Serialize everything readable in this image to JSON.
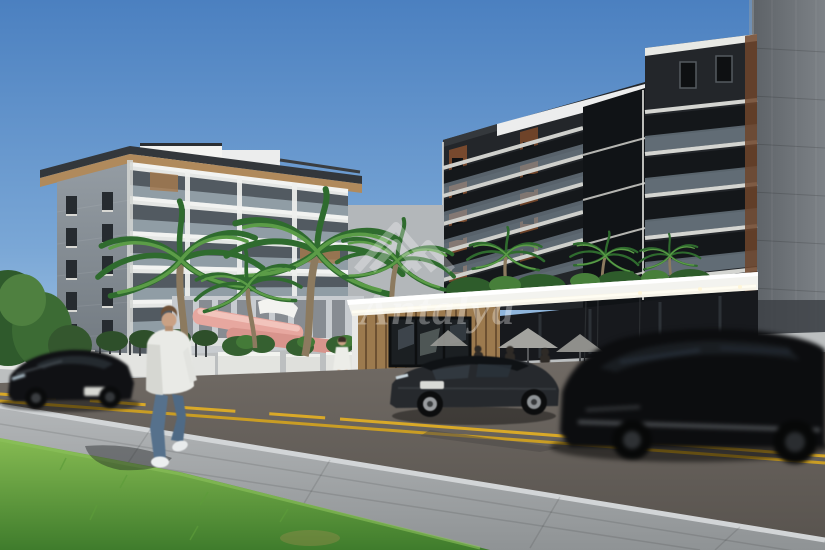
{
  "scene": {
    "type": "architectural-3d-render",
    "description": "Street-level render of a residential project: white 6-storey apartment block on the left, dark modern apartment block with wood accents on the right, cafe entrance canopy with LED strip, palm trees, parked sedan, two moving black cars, pedestrian crossing sidewalk",
    "time_of_day": "day",
    "sky": "clear blue gradient"
  },
  "watermark": {
    "text": "Antalya",
    "logo": "mountain-peaks-icon",
    "color": "#ffffff",
    "opacity": 0.32
  },
  "buildings": {
    "left_building": {
      "style": "white facade with balconies",
      "floors": 6,
      "side_wall": "grey panels, 2 window columns x 5 rows",
      "roof": "flat with wood soffit overhang"
    },
    "right_building": {
      "style": "dark charcoal with wood accents and glass balconies",
      "floors_visible": 6,
      "core": "black vertical center section"
    },
    "far_right_tower": {
      "style": "grey concrete panel facade"
    },
    "cafe_entrance": {
      "canopy": "white slab with LED light strip",
      "walls": "vertical wood slats and dark glass",
      "umbrellas": 2
    }
  },
  "street": {
    "lane_marking": "double yellow center line, dashed on left段 segment",
    "surfaces": [
      "asphalt road",
      "paved sidewalk",
      "grass verge"
    ]
  },
  "vehicles": [
    {
      "name": "black-sports-sedan",
      "state": "moving left, motion blurred"
    },
    {
      "name": "grey-parked-sedan",
      "state": "parked at cafe"
    },
    {
      "name": "black-suv",
      "state": "moving right, heavy motion blur, foreground"
    }
  ],
  "people": [
    {
      "name": "pedestrian-man",
      "clothing": "white jacket, blue jeans, white sneakers",
      "action": "walking on sidewalk"
    },
    {
      "name": "woman-in-white-dress",
      "action": "walking near planters"
    },
    {
      "name": "cafe-guests",
      "action": "seated under umbrellas"
    }
  ],
  "vegetation": {
    "palm_trees": 7,
    "planters": "white boxes with shrubs",
    "waterslide_color": "#e2a099"
  },
  "palette": {
    "sky_top": "#4b80c0",
    "sky_horizon": "#cfe0ee",
    "left_facade": "#e9ebe9",
    "left_side_wall": "#8d959c",
    "right_building_dark": "#23262a",
    "wood_accent": "#7a4c2e",
    "tower_grey": "#6b7075",
    "canopy_white": "#f3f3ef",
    "led_strip": "#fff8e0",
    "road_asphalt": "#66615c",
    "lane_yellow": "#d9a928",
    "grass": "#5f9c3c",
    "sidewalk": "#a7abad",
    "car_black": "#0e0f11",
    "sedan_grey": "#26292d",
    "slide_pink": "#e2a099"
  }
}
